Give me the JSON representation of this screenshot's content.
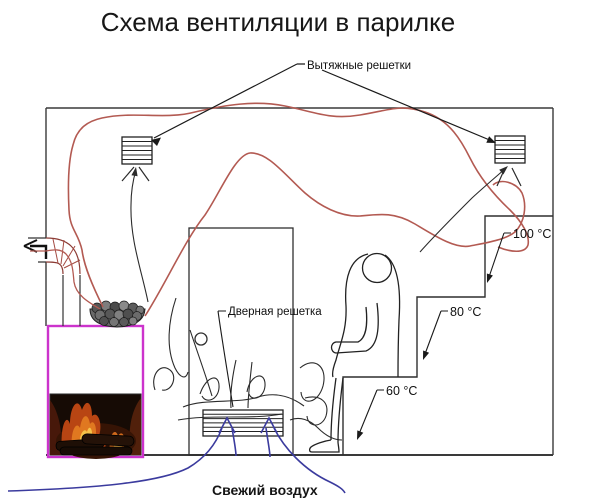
{
  "title": "Схема вентиляции в парилке",
  "diagram": {
    "labels": {
      "exhaust_grilles": "Вытяжные решетки",
      "door_grille": "Дверная решетка",
      "fresh_air": "Свежий воздух"
    },
    "temperatures": [
      {
        "zone": "upper-shelf",
        "value": "100 °C"
      },
      {
        "zone": "middle-shelf",
        "value": "80 °C"
      },
      {
        "zone": "lower-shelf",
        "value": "60 °C"
      }
    ],
    "icons": {
      "chimney_exhaust_direction": "left-arrow",
      "fresh_air_direction": "up-arrow",
      "grilles": "hatched-grille"
    },
    "colors": {
      "hot_air_flow": "#b35a52",
      "fresh_air_flow": "#3b3b9e",
      "stove_outline": "#cc33cc",
      "diagram_lines": "#2f2f2f"
    }
  }
}
